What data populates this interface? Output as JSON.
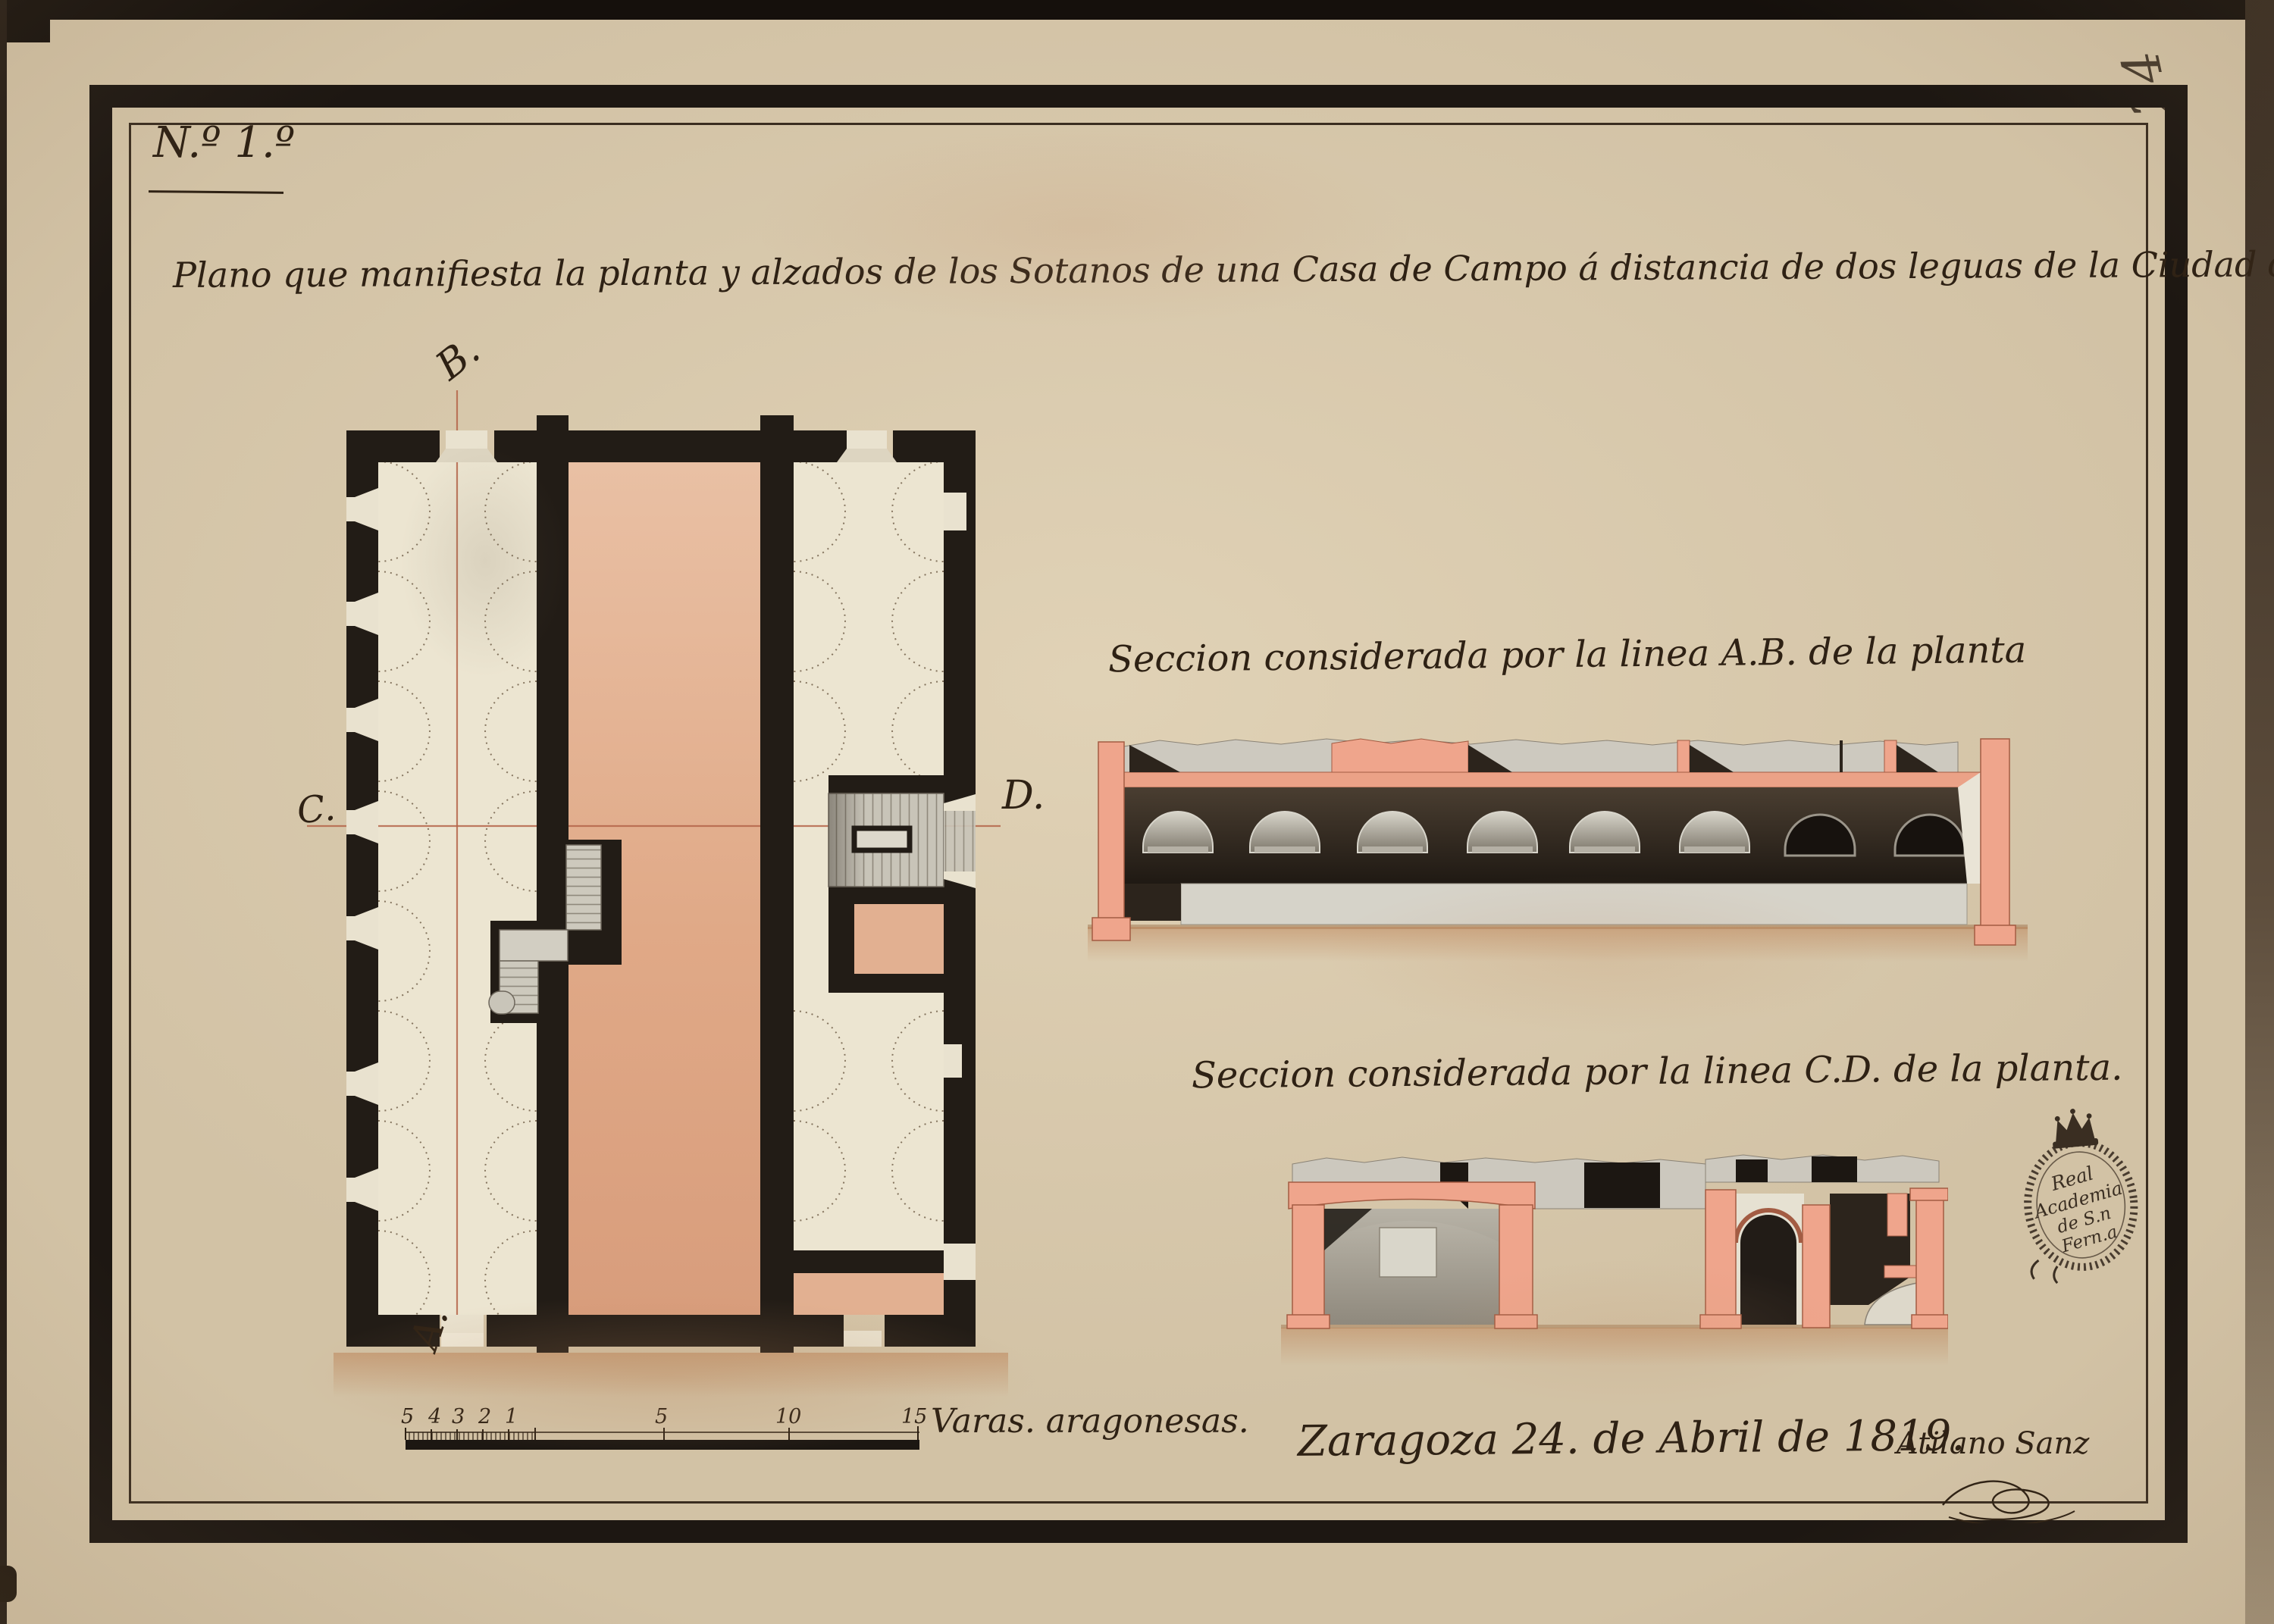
{
  "page": {
    "corner_number": "24"
  },
  "doc": {
    "sheet_no": "N.º 1.º",
    "title": "Plano que manifiesta la planta y alzados de los Sotanos de una Casa de Campo á distancia de dos leguas de la Ciudad de Zaragoza.",
    "section_ab_label": "Seccion considerada por la linea A.B. de la planta",
    "section_cd_label": "Seccion considerada por la linea C.D. de la planta.",
    "plan": {
      "marker_top": "B.",
      "marker_bottom": "A.",
      "marker_left": "C.",
      "marker_right": "D."
    },
    "scale": {
      "left_numbers": [
        "5",
        "4",
        "3",
        "2",
        "1"
      ],
      "main_numbers": [
        "5",
        "10",
        "15"
      ],
      "label": "Varas. aragonesas."
    },
    "date_line": "Zaragoza 24. de Abril de 1819.",
    "signature": "Atilano Sanz",
    "stamp": {
      "line1": "Real",
      "line2": "Academia",
      "line3": "de S.n",
      "line4": "Fern.a"
    }
  },
  "colors": {
    "paper": "#d2c2a5",
    "ink": "#2e2114",
    "wall_black": "#221c16",
    "plan_pink": "#e2b091",
    "section_pink": "#efa58c",
    "stair_gray": "#c8c4b8",
    "section_dark": "#2c241c",
    "section_line_red": "#b5664a"
  }
}
